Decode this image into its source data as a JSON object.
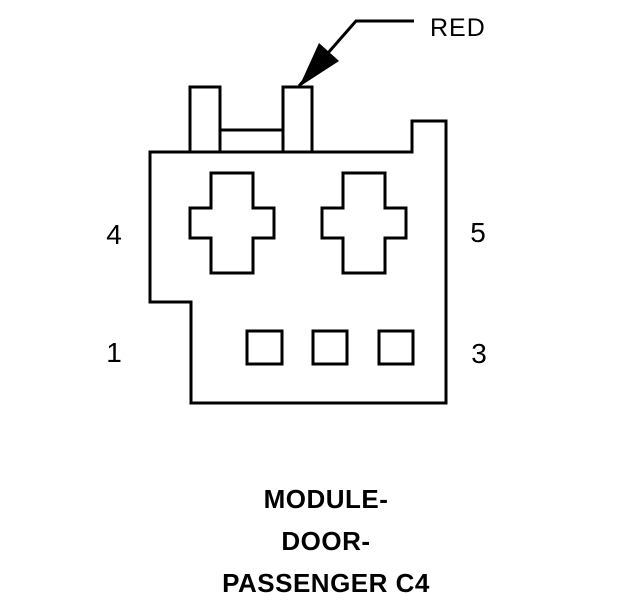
{
  "colors": {
    "line": "#000000",
    "background": "#ffffff",
    "text": "#000000"
  },
  "diagram": {
    "wire_label": "RED",
    "pins": [
      {
        "label": "4",
        "position": "left-top"
      },
      {
        "label": "5",
        "position": "right-top"
      },
      {
        "label": "1",
        "position": "left-bottom"
      },
      {
        "label": "3",
        "position": "right-bottom"
      }
    ],
    "caption": {
      "line1": "MODULE-",
      "line2": "DOOR-",
      "line3": "PASSENGER C4"
    }
  }
}
